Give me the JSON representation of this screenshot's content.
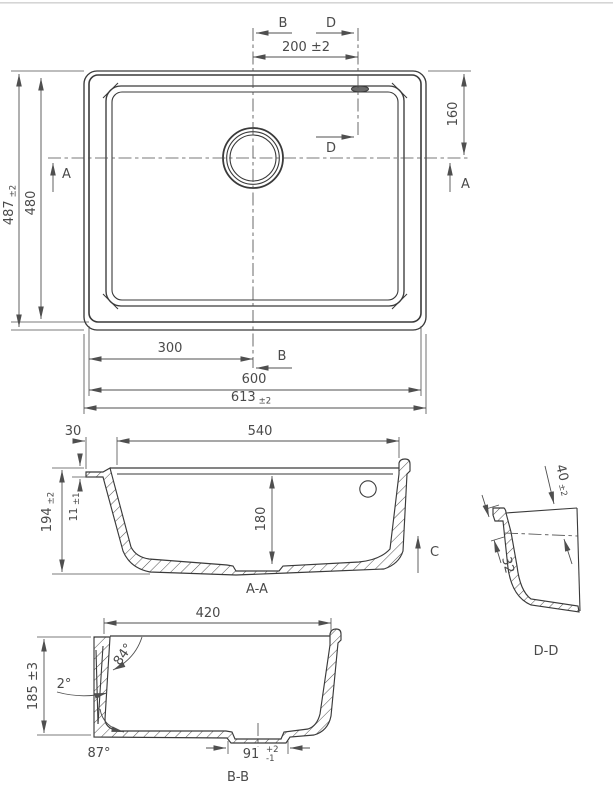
{
  "plan": {
    "label_b": "B",
    "label_d": "D",
    "label_a": "A",
    "dim_bowl_center_to_d": "200 ±2",
    "dim_drain_from_top": "160",
    "dim_height_overall": "487",
    "dim_height_overall_tol": "±2",
    "dim_height_body": "480",
    "dim_center_from_left": "300",
    "dim_width_body": "600",
    "dim_width_overall": "613",
    "dim_width_overall_tol": "±2"
  },
  "section_aa": {
    "label": "A-A",
    "label_c": "C",
    "dim_rim": "30",
    "dim_bowl_width_top": "540",
    "dim_depth_overall": "194",
    "dim_depth_overall_tol": "±2",
    "dim_rim_step": "11",
    "dim_rim_step_tol": "±1",
    "dim_depth_inner": "180"
  },
  "section_dd": {
    "label": "D-D",
    "dim_overflow_center": "40",
    "dim_overflow_center_tol": "±2",
    "dim_lip": "32"
  },
  "section_bb": {
    "label": "B-B",
    "dim_bowl_width": "420",
    "dim_depth": "185 ±3",
    "angle_wall": "84°",
    "angle_taper": "2°",
    "angle_bottom": "87°",
    "dim_drain_recess": "91",
    "dim_drain_recess_tol_plus": "+2",
    "dim_drain_recess_tol_minus": "-1"
  }
}
